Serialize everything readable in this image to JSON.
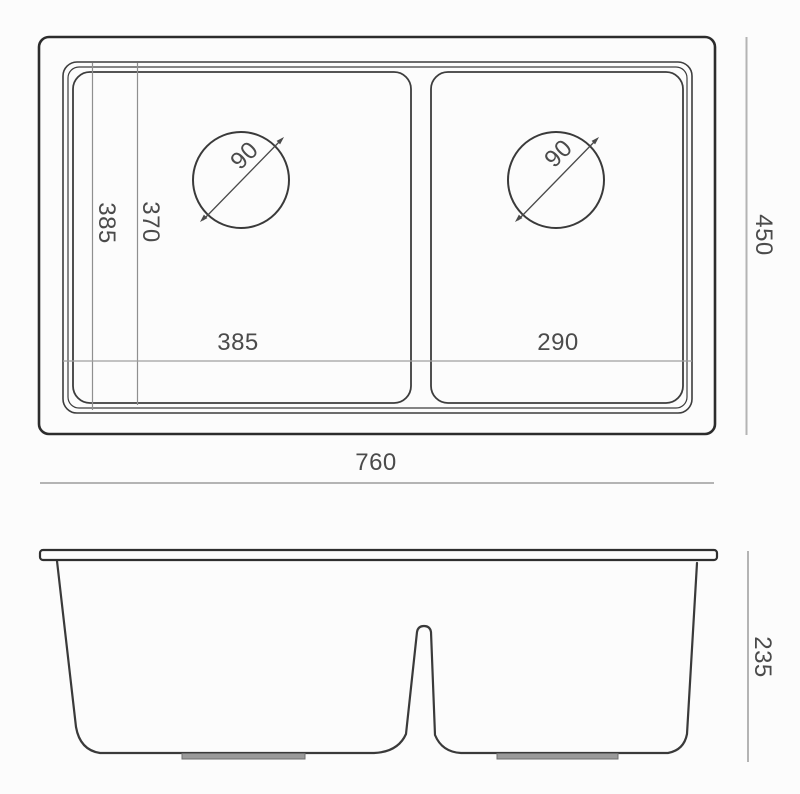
{
  "drawing": {
    "type": "technical-drawing",
    "subject": "double-bowl undermount kitchen sink, top view and side section view"
  },
  "colors": {
    "background": "#fcfcfc",
    "outline_dark": "#2c2c2c",
    "line_medium": "#3d3d3d",
    "extension_line": "#8f8f8f",
    "dimension_line": "#b4b4b4",
    "label_text": "#4b4b4b",
    "pad_fill": "#9a9a9a"
  },
  "top_view": {
    "overall_width": "760",
    "overall_depth": "450",
    "left_bowl_front_depth": "385",
    "left_bowl_inner_depth": "370",
    "left_bowl_width": "385",
    "right_bowl_width": "290",
    "left_drain_diameter": "90",
    "right_drain_diameter": "90"
  },
  "side_view": {
    "bowl_height": "235"
  }
}
